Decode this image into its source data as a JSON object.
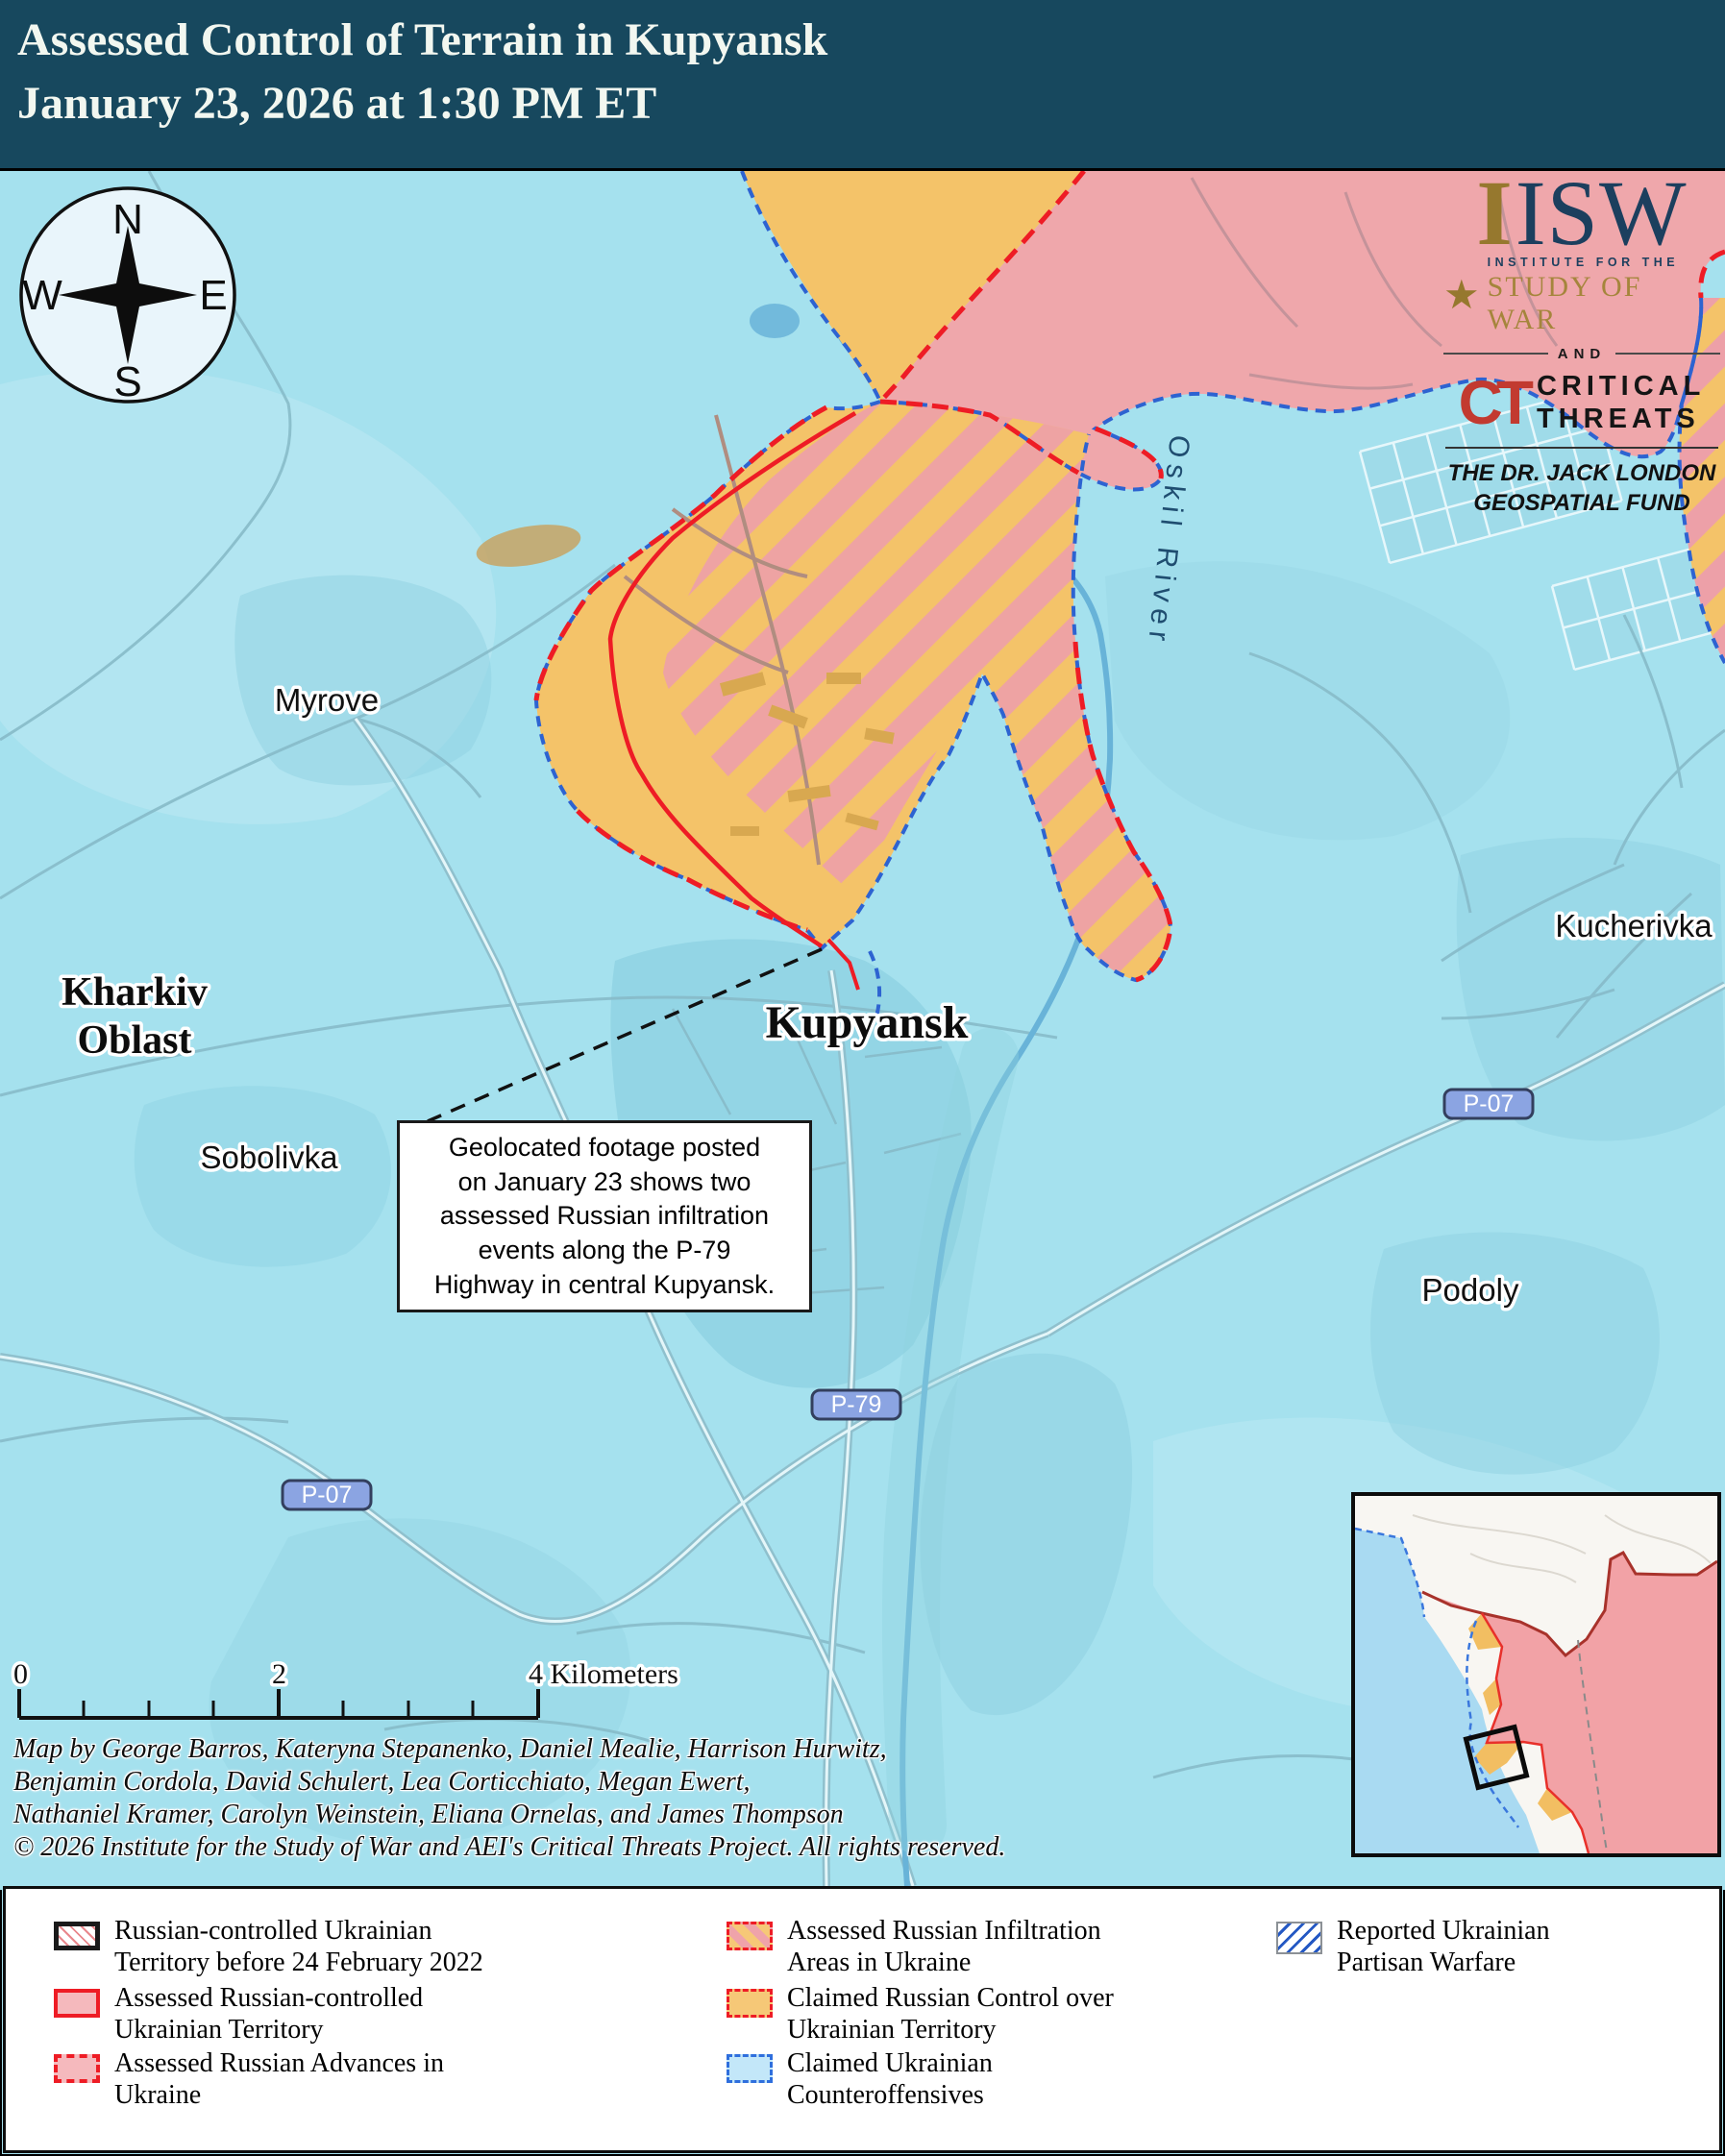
{
  "header": {
    "title_line1": "Assessed Control of Terrain in Kupyansk",
    "title_line2": "January 23, 2026 at 1:30 PM ET"
  },
  "logo": {
    "isw_prefix": "I",
    "isw": "ISW",
    "star": "★",
    "institute": "INSTITUTE FOR THE",
    "study": "STUDY OF WAR",
    "and": "AND",
    "ct": "CT",
    "critical": "CRITICAL",
    "threats": "THREATS",
    "fund_line1": "THE DR. JACK LONDON",
    "fund_line2": "GEOSPATIAL FUND"
  },
  "compass": {
    "n": "N",
    "e": "E",
    "s": "S",
    "w": "W"
  },
  "map_labels": {
    "myrove": "Myrove",
    "kharkiv_line1": "Kharkiv",
    "kharkiv_line2": "Oblast",
    "sobolivka": "Sobolivka",
    "kupyansk": "Kupyansk",
    "kucherivka": "Kucherivka",
    "podoly": "Podoly",
    "oskil_river": "Oskil River",
    "road_p07_west": "P-07",
    "road_p07_east": "P-07",
    "road_p79": "P-79"
  },
  "annotation": {
    "lines": [
      "Geolocated footage posted",
      "on January 23 shows two",
      "assessed Russian infiltration",
      "events along the P-79",
      "Highway in central Kupyansk."
    ]
  },
  "scale_bar": {
    "tick_start": "0",
    "tick_mid": "2",
    "label_end": "4 Kilometers"
  },
  "credits": {
    "line1": "Map by George Barros, Kateryna Stepanenko, Daniel Mealie, Harrison Hurwitz,",
    "line2": "Benjamin Cordola, David Schulert, Lea Corticchiato, Megan Ewert,",
    "line3": "Nathaniel Kramer, Carolyn Weinstein, Eliana Ornelas, and James Thompson",
    "line4": "© 2026 Institute for the Study of War and AEI's Critical Threats Project. All rights reserved."
  },
  "legend": {
    "items": [
      {
        "line1": "Russian-controlled Ukrainian",
        "line2": "Territory before 24 February 2022"
      },
      {
        "line1": "Assessed Russian-controlled",
        "line2": "Ukrainian Territory"
      },
      {
        "line1": "Assessed Russian Advances in",
        "line2": "Ukraine"
      },
      {
        "line1": "Assessed Russian Infiltration",
        "line2": "Areas in Ukraine"
      },
      {
        "line1": "Claimed Russian Control over",
        "line2": "Ukrainian Territory"
      },
      {
        "line1": "Claimed Ukrainian",
        "line2": "Counteroffensives"
      },
      {
        "line1": "Reported Ukrainian",
        "line2": "Partisan Warfare"
      }
    ]
  },
  "colors": {
    "header_bg": "#17485E",
    "ukrainian_claim_blue": "#A5E1EE",
    "claimed_russian_yellow": "#F4C369",
    "assessed_russian_pink": "#EFA7AB",
    "infiltration_stripe_pink": "#EDA0A8",
    "red_line": "#EE1C25",
    "blue_dash": "#2D63D1",
    "water": "#68B3D8",
    "isw_gold": "#A5853C",
    "isw_navy": "#1C3F5E",
    "ct_red": "#C23A30"
  }
}
